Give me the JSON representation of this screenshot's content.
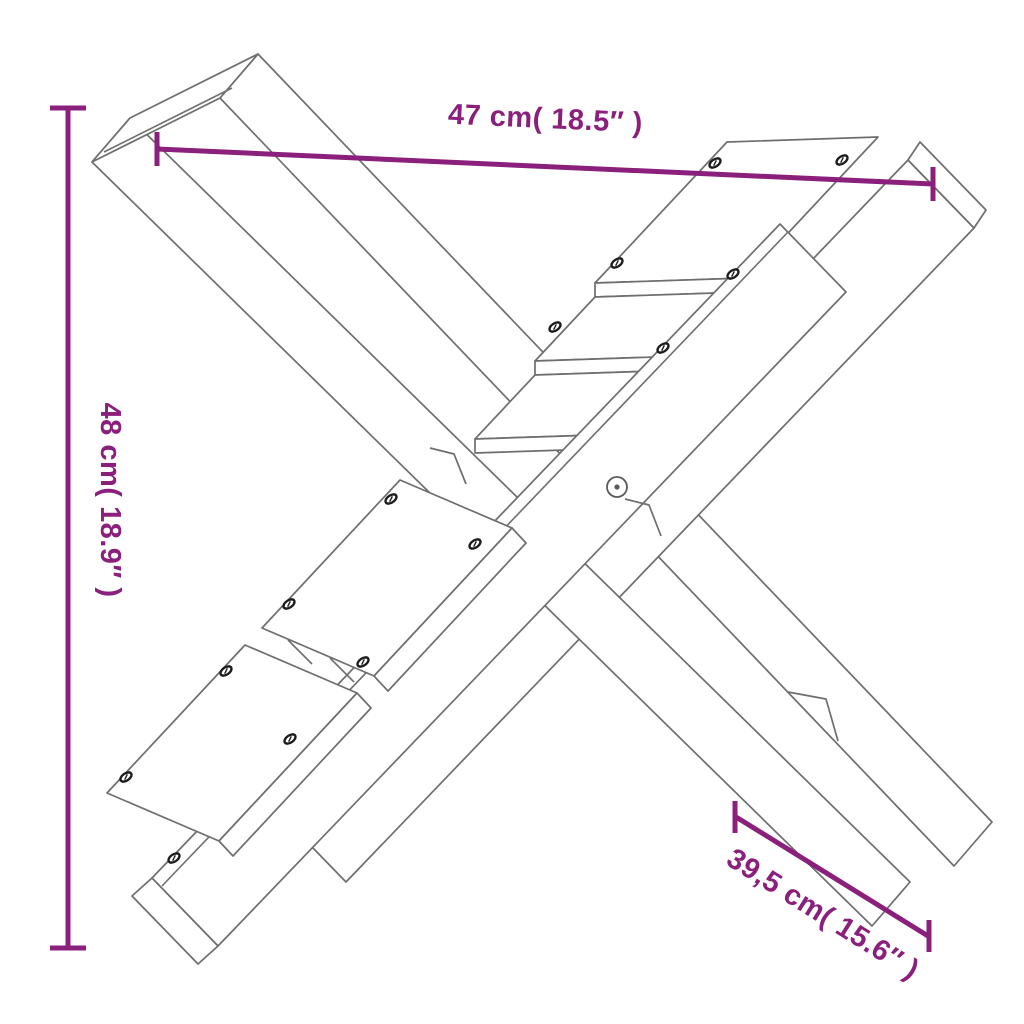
{
  "diagram": {
    "background_color": "#ffffff",
    "line_color": "#6e6e6e",
    "accent_color": "#8a1f7c",
    "subject": "x-shaped wooden log holder line drawing",
    "dimensions": {
      "width": {
        "cm": "47",
        "inches": "18.5",
        "label": "47 cm( 18.5″ )"
      },
      "height": {
        "cm": "48",
        "inches": "18.9",
        "label": "48 cm( 18.9″ )"
      },
      "foot": {
        "cm": "39,5",
        "inches": "15.6",
        "label": "39,5 cm( 15.6″ )"
      }
    }
  }
}
